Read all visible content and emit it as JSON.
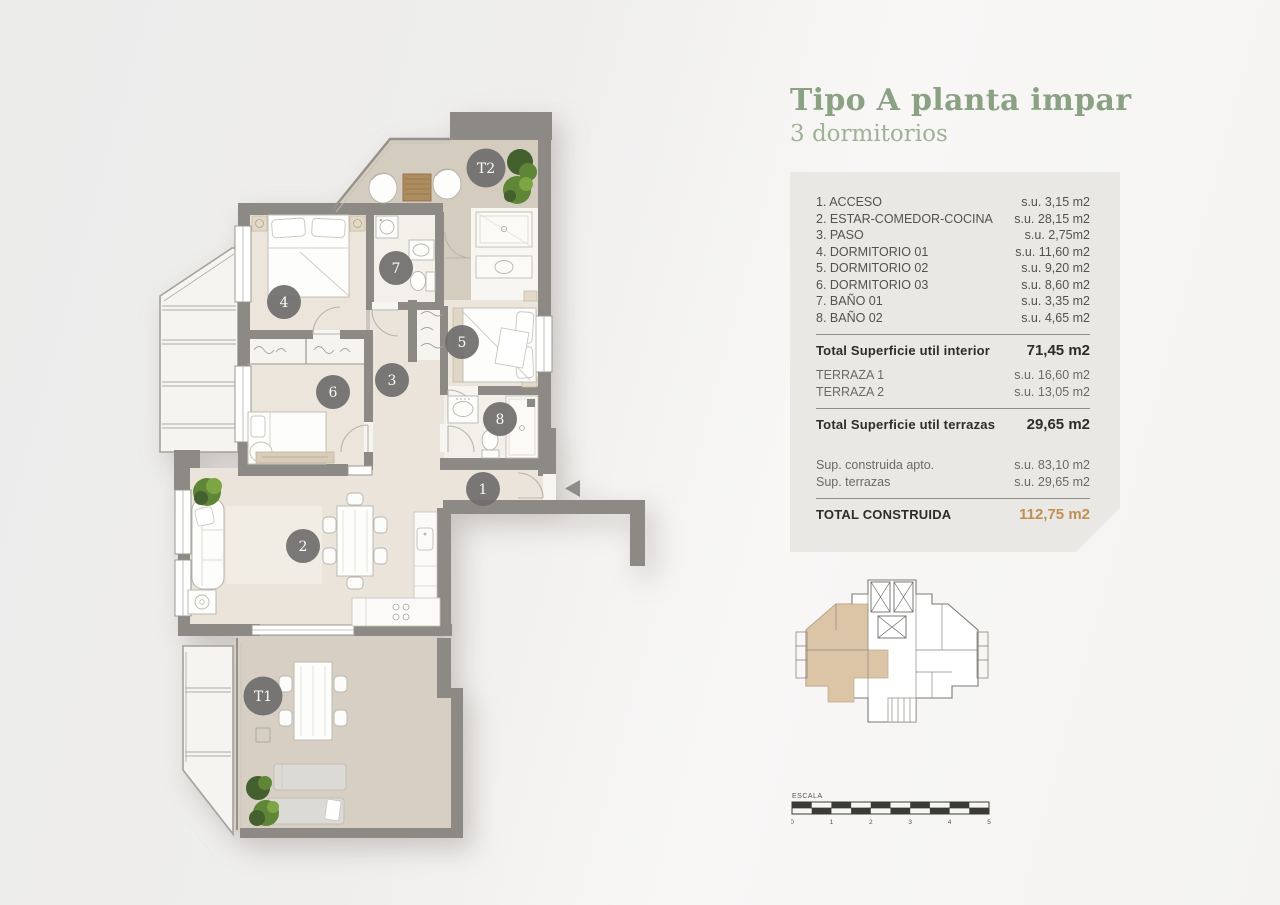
{
  "title": "Tipo A planta impar",
  "subtitle": "3 dormitorios",
  "panel": {
    "rooms": [
      {
        "label": "1. ACCESO",
        "value": "s.u. 3,15 m2"
      },
      {
        "label": "2. ESTAR-COMEDOR-COCINA",
        "value": "s.u. 28,15 m2"
      },
      {
        "label": "3. PASO",
        "value": "s.u. 2,75m2"
      },
      {
        "label": "4. DORMITORIO 01",
        "value": "s.u. 11,60 m2"
      },
      {
        "label": "5. DORMITORIO 02",
        "value": "s.u. 9,20 m2"
      },
      {
        "label": "6. DORMITORIO 03",
        "value": "s.u. 8,60 m2"
      },
      {
        "label": "7. BAÑO 01",
        "value": "s.u. 3,35 m2"
      },
      {
        "label": "8. BAÑO 02",
        "value": "s.u. 4,65 m2"
      }
    ],
    "total_interior": {
      "label": "Total Superficie util interior",
      "value": "71,45 m2"
    },
    "terraces": [
      {
        "label": "TERRAZA 1",
        "value": "s.u. 16,60 m2"
      },
      {
        "label": "TERRAZA 2",
        "value": "s.u. 13,05 m2"
      }
    ],
    "total_terraces": {
      "label": "Total Superficie util terrazas",
      "value": "29,65 m2"
    },
    "built": [
      {
        "label": "Sup. construida apto.",
        "value": "s.u. 83,10 m2"
      },
      {
        "label": "Sup. terrazas",
        "value": "s.u. 29,65 m2"
      }
    ],
    "total_built": {
      "label": "TOTAL CONSTRUIDA",
      "value": "112,75 m2"
    }
  },
  "plan": {
    "room_markers": [
      {
        "id": "t2",
        "label": "T2"
      },
      {
        "id": "7",
        "label": "7"
      },
      {
        "id": "4",
        "label": "4"
      },
      {
        "id": "5",
        "label": "5"
      },
      {
        "id": "3",
        "label": "3"
      },
      {
        "id": "6",
        "label": "6"
      },
      {
        "id": "8",
        "label": "8"
      },
      {
        "id": "1",
        "label": "1"
      },
      {
        "id": "2",
        "label": "2"
      },
      {
        "id": "t1",
        "label": "T1"
      }
    ]
  },
  "scale_bar": {
    "label": "ESCALA",
    "ticks": [
      "0",
      "1",
      "2",
      "3",
      "4",
      "5"
    ]
  },
  "colors": {
    "title_green": "#8ba184",
    "subtitle_green": "#9eb295",
    "accent_tan": "#c28e54",
    "panel_bg": "#e9e8e4",
    "wall_gray": "#8d8a86",
    "interior_floor": "#ebe4db",
    "terrace_floor": "#d5ccc0",
    "keyplan_highlight": "#dcc4a6",
    "marker_gray": "#6f6e6c"
  }
}
